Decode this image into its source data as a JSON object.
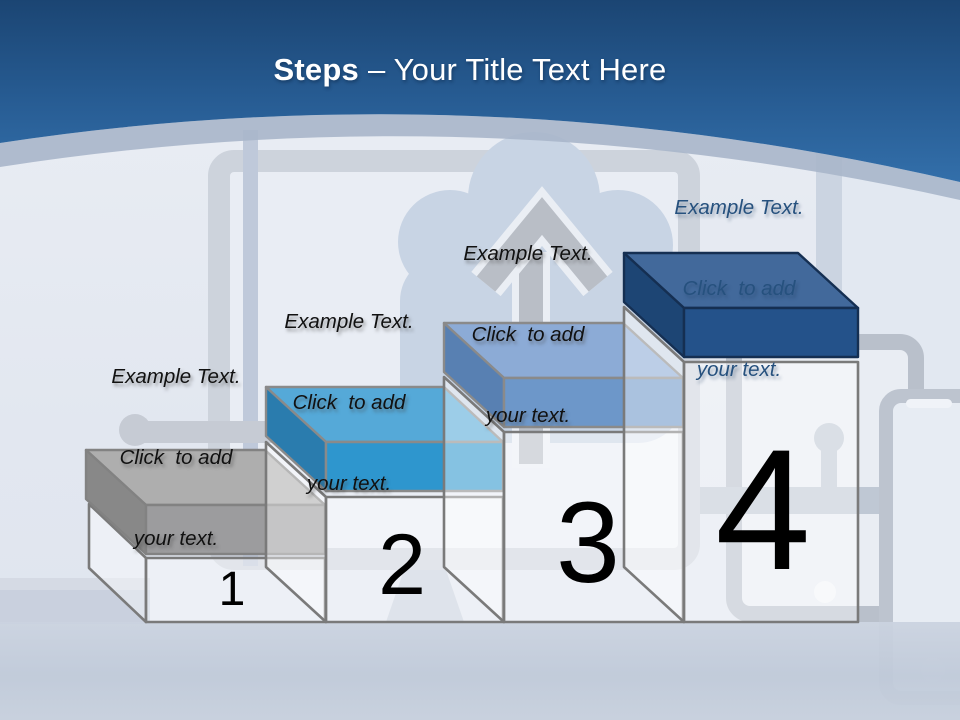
{
  "title": {
    "prefix": "Steps",
    "suffix": "– Your Title Text Here"
  },
  "colors": {
    "title_text": "#FFFFFF",
    "number_text": "#000000",
    "header_gradient": [
      "#1B4573",
      "#275C93",
      "#336FAA"
    ],
    "header_band": "#A9B6CA",
    "pedestal_fill": "rgba(255,255,255,0.42)",
    "pedestal_stroke": "#7A7A7A",
    "background_base": "#E4E9F1",
    "floor": "#C4CCDA"
  },
  "background_icons": [
    "cloud-upload-icon",
    "monitor-icon",
    "tablet-icon",
    "smartphone-icon",
    "circuit-trace-icon"
  ],
  "steps": [
    {
      "number": "1",
      "label_lines": [
        "Example Text.",
        "Click  to add",
        "your text."
      ],
      "label_color": "#111111",
      "colors": {
        "top": "#AEAEAE",
        "front": "#9C9C9E",
        "side": "#888888",
        "outline": "#828282"
      }
    },
    {
      "number": "2",
      "label_lines": [
        "Example Text.",
        "Click  to add",
        "your text."
      ],
      "label_color": "#111111",
      "colors": {
        "top": "#55A9D8",
        "front": "#2E96CE",
        "side": "#2A7CAE",
        "outline": "#8A8A8A"
      }
    },
    {
      "number": "3",
      "label_lines": [
        "Example Text.",
        "Click  to add",
        "your text."
      ],
      "label_color": "#111111",
      "colors": {
        "top": "#8CABD6",
        "front": "#6D97C9",
        "side": "#5880B2",
        "outline": "#8A8A8A"
      }
    },
    {
      "number": "4",
      "label_lines": [
        "Example Text.",
        "Click  to add",
        "your text."
      ],
      "label_color": "#26517E",
      "colors": {
        "top": "#42699B",
        "front": "#24528A",
        "side": "#1D4574",
        "outline": "#152F52"
      }
    }
  ]
}
